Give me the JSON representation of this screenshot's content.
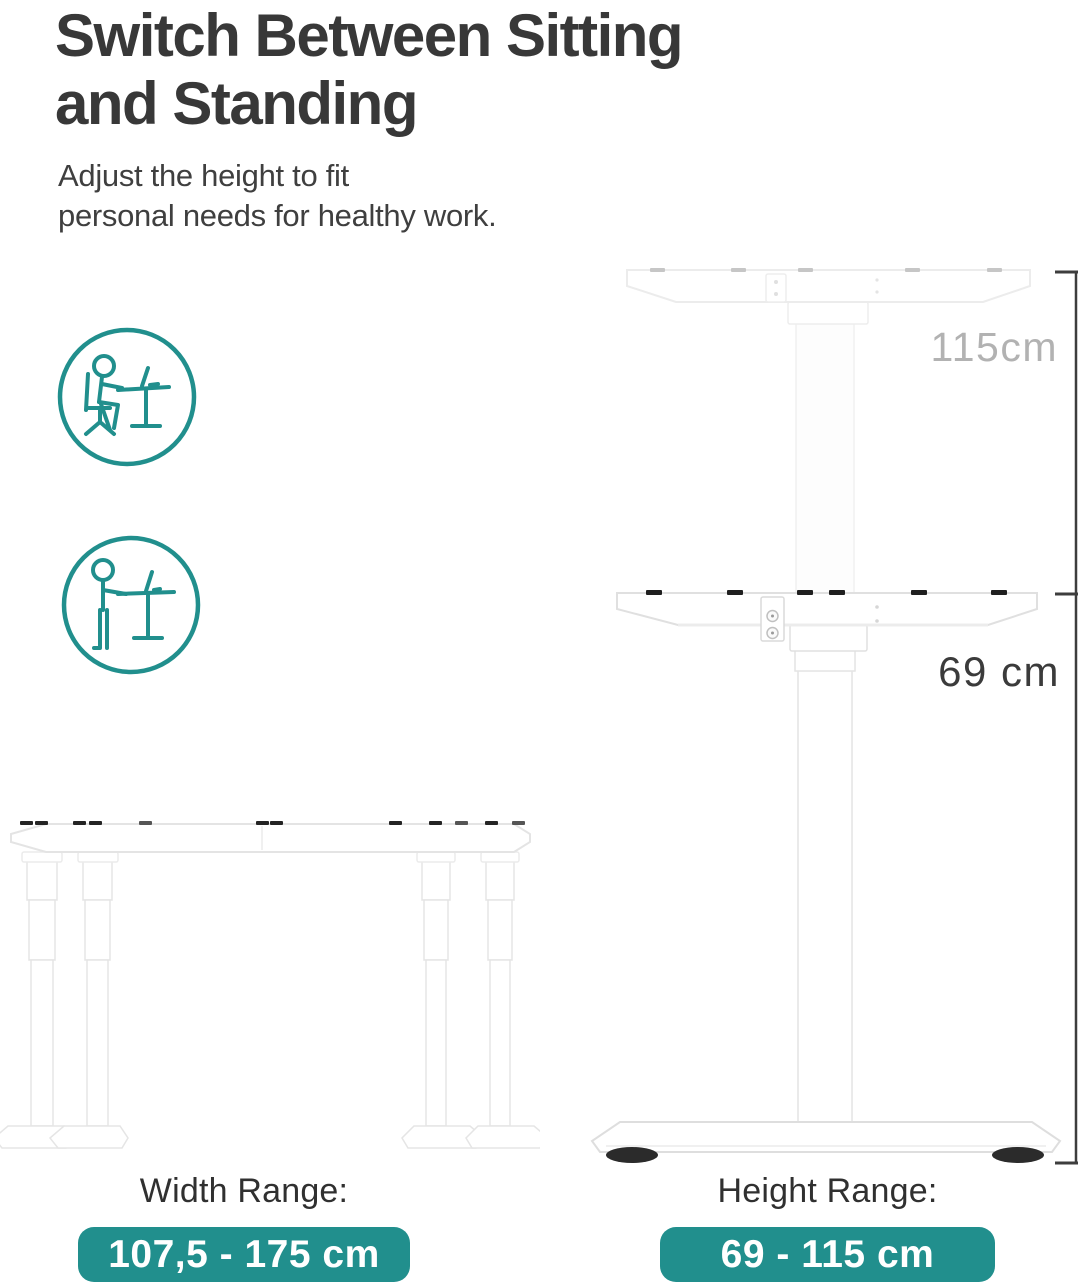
{
  "colors": {
    "accent_teal": "#218f8d",
    "text_dark": "#383838",
    "label_muted": "#b2b2b2",
    "frame_white": "#ffffff",
    "foot_pad_black": "#2b2b2b"
  },
  "header": {
    "title_line1": "Switch Between Sitting",
    "title_line2": "and Standing",
    "subtitle_line1": "Adjust the height to fit",
    "subtitle_line2": "personal needs for healthy work."
  },
  "icons": {
    "sitting": "person-sitting-at-desk",
    "standing": "person-standing-at-desk"
  },
  "diagram": {
    "standing_height": "115cm",
    "sitting_height": "69 cm"
  },
  "ranges": {
    "width": {
      "label": "Width Range:",
      "value": "107,5 - 175 cm"
    },
    "height": {
      "label": "Height Range:",
      "value": "69 - 115 cm"
    }
  }
}
